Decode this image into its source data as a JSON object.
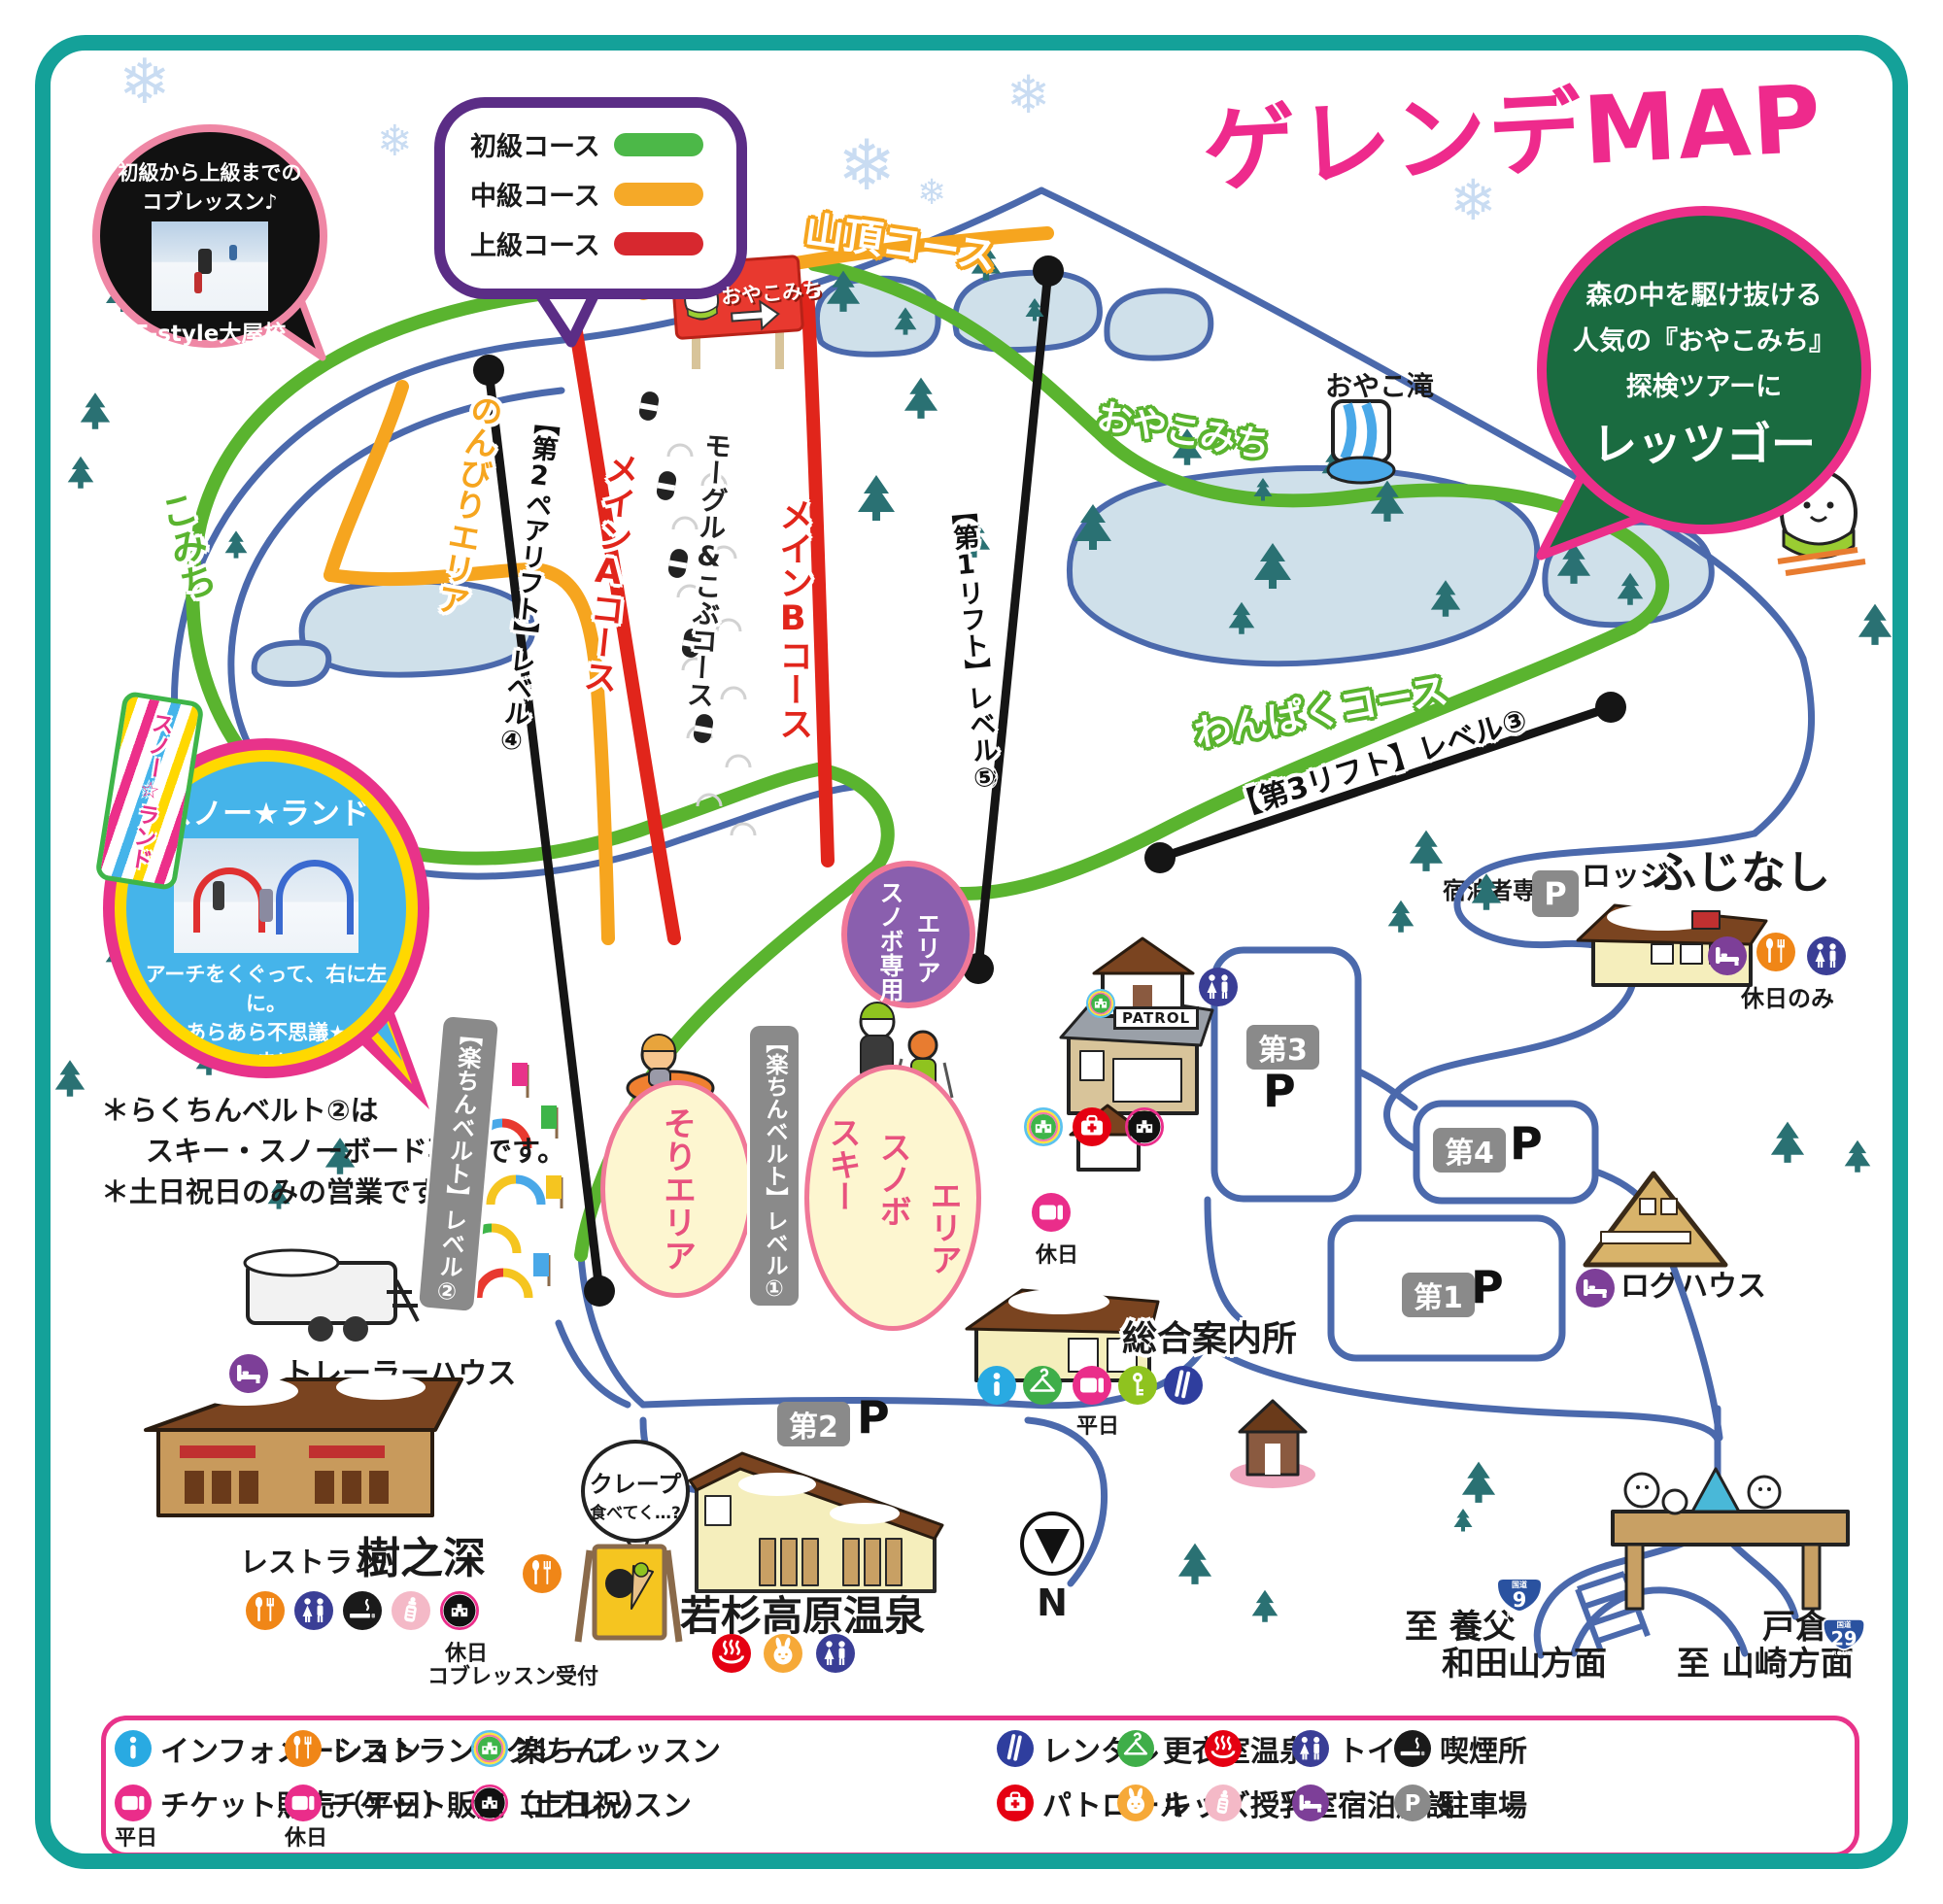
{
  "title": "ゲレンデMAP",
  "lesson_bubble": {
    "line1": "初級から上級までの",
    "line2": "コブレッスン♪",
    "school": "F-style大屋校"
  },
  "course_legend": {
    "items": [
      {
        "label": "初級コース",
        "color": "#4cb848"
      },
      {
        "label": "中級コース",
        "color": "#f5a928"
      },
      {
        "label": "上級コース",
        "color": "#d7282f"
      }
    ]
  },
  "tour_bubble": {
    "line1": "森の中を駆け抜ける",
    "line2": "人気の『おやこみち』",
    "line3": "探検ツアーに",
    "line4": "レッツゴー"
  },
  "sign": {
    "oyakomichi": "おやこみち"
  },
  "courses": {
    "santyo": "山頂コース",
    "oyakomichi": "おやこみち",
    "nonbiri": "のんびりエリア",
    "komichi": "こみち",
    "mainA": "メインAコース",
    "mogul": "モーグル&こぶコース",
    "mainB": "メインBコース",
    "wanpaku": "わんぱくコース"
  },
  "lifts": {
    "lift1": "【第1リフト】レベル⑤",
    "lift2": "【第2ペアリフト】レベル④",
    "lift3": "【第3リフト】レベル③"
  },
  "belts": {
    "belt1": "【楽ちんベルト】レベル①",
    "belt2": "【楽ちんベルト】レベル②"
  },
  "waterfall_label": "おやこ滝",
  "snowland": {
    "flag": "スノー☆ランド",
    "title": "スノー★ランド",
    "line1": "アーチをくぐって、右に左に。",
    "line2": "あらあら不思議★",
    "line3": "いつのまにやら",
    "line4": "楽しく上達♪"
  },
  "notes": {
    "line1": "＊らくちんベルト②は",
    "line2": "スキー・スノーボード専用です。",
    "line3": "＊土日祝日のみの営業です。"
  },
  "areas": {
    "snowboard_l1": "スノボ専用",
    "snowboard_l2": "エリア",
    "sled": "そりエリア",
    "ski_l1": "スキー",
    "ski_l2": "スノボ",
    "ski_l3": "エリア"
  },
  "facilities": {
    "trailer": "トレーラーハウス",
    "restaurant_prefix": "レストラン",
    "restaurant_name": "樹之深",
    "restaurant_note1": "休日",
    "restaurant_note2": "コブレッスン受付",
    "patrol_sign": "PATROL",
    "crepe_l1": "クレープ",
    "crepe_l2": "食べてく…?",
    "onsen_name": "若杉高原温泉",
    "info_center": "総合案内所",
    "weekday": "平日",
    "holiday": "休日",
    "lodge_prefix": "ロッジ",
    "lodge_name": "ふじなし",
    "lodge_note": "休日のみ",
    "lodge_parking": "宿泊者専用",
    "loghouse": "ログハウス"
  },
  "parking": {
    "p1": "第1",
    "p2": "第2",
    "p3": "第3",
    "p4": "第4",
    "p": "P"
  },
  "compass_n": "N",
  "directions": {
    "left1": "至 養父",
    "left2": "和田山方面",
    "right1": "戸倉",
    "right2": "至 山崎方面",
    "kokudo": "国道",
    "route9": "9",
    "route29": "29",
    "route_word": "ROUTE"
  },
  "legend": {
    "rows": [
      [
        {
          "icon": "info",
          "label": "インフォメーション"
        },
        {
          "icon": "restaurant",
          "label": "レストラン・クレープ"
        },
        {
          "icon": "lesson",
          "label": "楽ちんレッスン"
        },
        {
          "icon": "rental",
          "label": "レンタル"
        },
        {
          "icon": "changing",
          "label": "更衣室"
        },
        {
          "icon": "onsen",
          "label": "温泉"
        },
        {
          "icon": "toilet",
          "label": "トイレ"
        },
        {
          "icon": "smoking",
          "label": "喫煙所"
        }
      ],
      [
        {
          "icon": "ticket",
          "label": "チケット販売（平日）",
          "caption": "平日"
        },
        {
          "icon": "ticket",
          "label": "チケット販売（土日祝）",
          "caption": "休日"
        },
        {
          "icon": "kob",
          "label": "コブレッスン"
        },
        {
          "icon": "patrol",
          "label": "パトロール"
        },
        {
          "icon": "kids",
          "label": "キッズ"
        },
        {
          "icon": "nursing",
          "label": "授乳室"
        },
        {
          "icon": "lodging",
          "label": "宿泊施設"
        },
        {
          "icon": "parking",
          "label": "駐車場"
        }
      ]
    ]
  }
}
